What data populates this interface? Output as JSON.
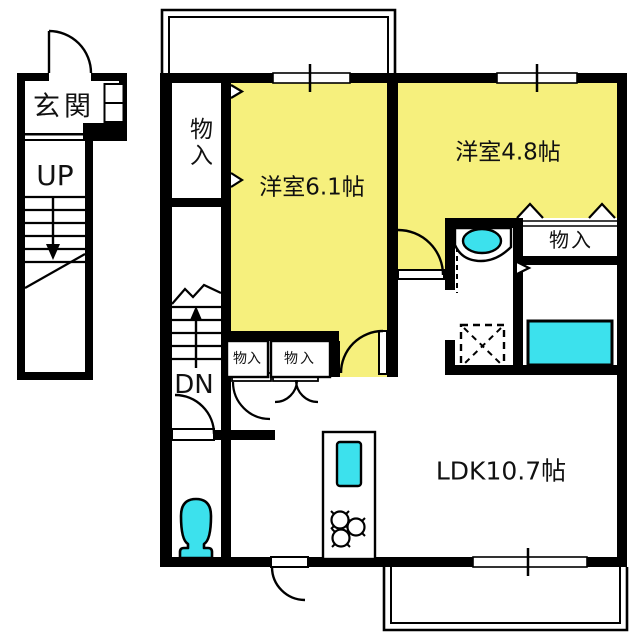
{
  "floorplan": {
    "labels": {
      "entrance": "玄関",
      "stairs_up": "UP",
      "stairs_down": "DN",
      "closet_top_left": "物入",
      "western_room_6_1": "洋室6.1帖",
      "western_room_4_8": "洋室4.8帖",
      "closet_right": "物入",
      "closet_hall_1": "物入",
      "closet_hall_2": "物入",
      "ldk": "LDK10.7帖"
    },
    "colors": {
      "room_fill": "#F6F07D",
      "fixture_fill": "#3CE1ED",
      "wall": "#000000",
      "background": "#FFFFFF"
    },
    "fixtures": {
      "toilet": "toilet-icon",
      "washbasin": "washbasin-icon",
      "washing_machine_space": "washing-machine-space-icon",
      "bathtub": "bathtub-icon",
      "kitchen_sink": "kitchen-sink-icon",
      "gas_stove": "gas-stove-icon"
    }
  }
}
